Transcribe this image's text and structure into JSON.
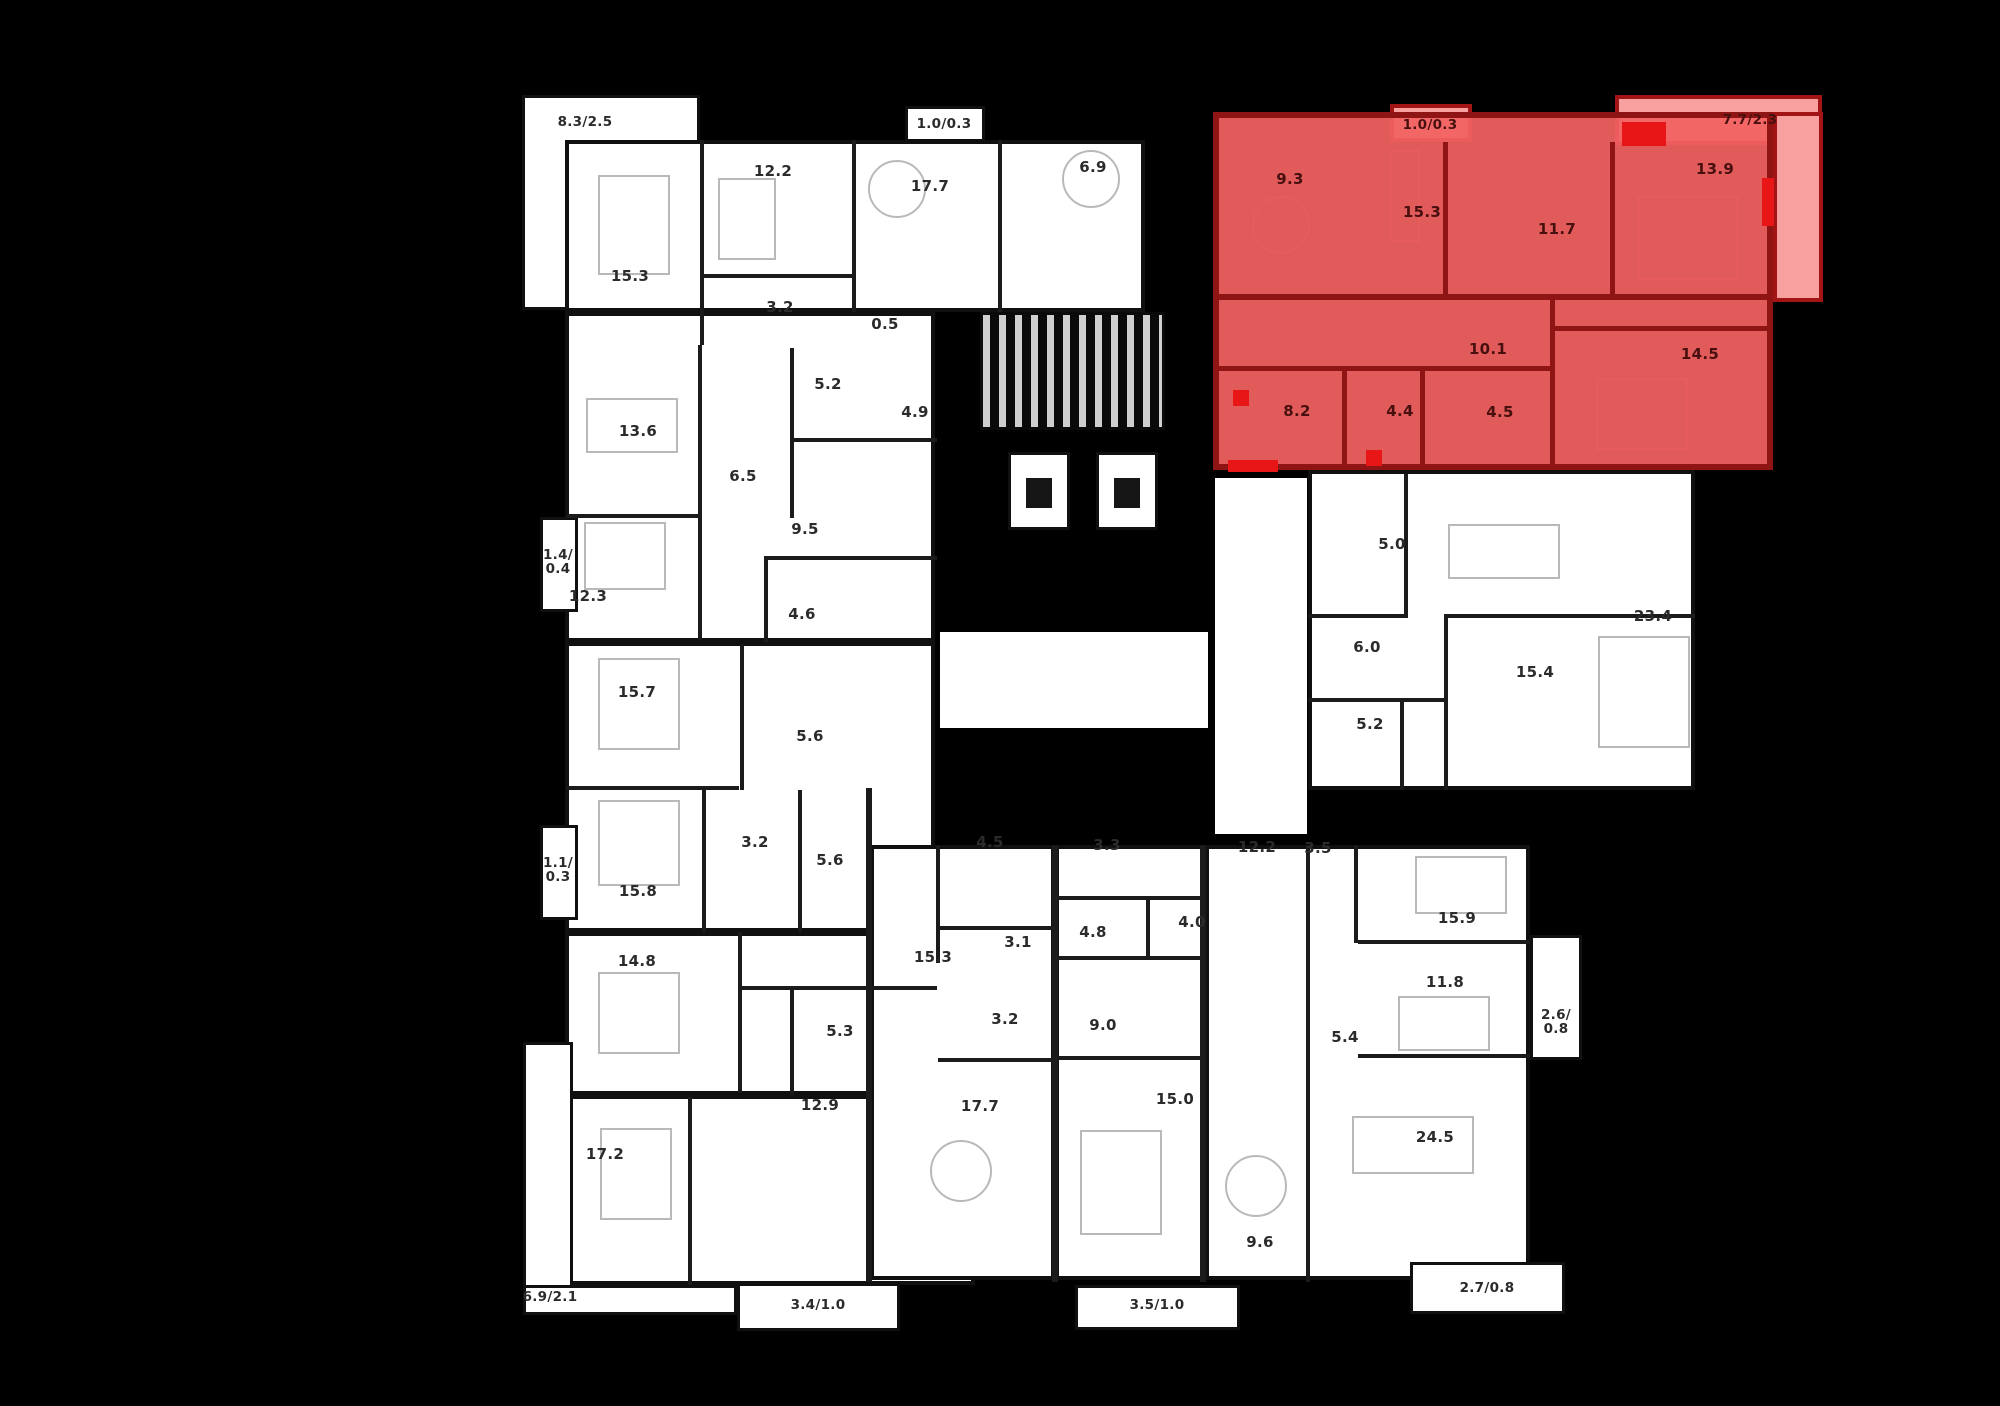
{
  "meta": {
    "view_title": "Residential building floor plan",
    "description": "Black-background architectural floor plate with one apartment highlighted in red (top right). Numbers are room areas in square meters; slash values are balcony/terrace areas."
  },
  "colors": {
    "background": "#000000",
    "floor_fill": "#ffffff",
    "wall": "#1b1b1b",
    "highlight_fill": "#f26262",
    "highlight_wall": "#8f1414",
    "highlight_balcony_fill": "#f8a0a0",
    "accent_red": "#e81616",
    "label_text": "#2b2b2b"
  },
  "highlighted_apartment": {
    "rooms": [
      {
        "area": "9.3",
        "x": 1290,
        "y": 180
      },
      {
        "area": "15.3",
        "x": 1422,
        "y": 213
      },
      {
        "area": "11.7",
        "x": 1557,
        "y": 230
      },
      {
        "area": "13.9",
        "x": 1715,
        "y": 170
      },
      {
        "area": "10.1",
        "x": 1488,
        "y": 350
      },
      {
        "area": "14.5",
        "x": 1700,
        "y": 355
      },
      {
        "area": "8.2",
        "x": 1297,
        "y": 412
      },
      {
        "area": "4.4",
        "x": 1400,
        "y": 412
      },
      {
        "area": "4.5",
        "x": 1500,
        "y": 413
      }
    ],
    "balconies": [
      {
        "area": "1.0/0.3",
        "x": 1430,
        "y": 125
      },
      {
        "area": "7.7/2.3",
        "x": 1750,
        "y": 120
      }
    ]
  },
  "rooms": [
    {
      "area": "15.3",
      "x": 630,
      "y": 277
    },
    {
      "area": "12.2",
      "x": 773,
      "y": 172
    },
    {
      "area": "3.2",
      "x": 780,
      "y": 308
    },
    {
      "area": "0.5",
      "x": 885,
      "y": 325
    },
    {
      "area": "17.7",
      "x": 930,
      "y": 187
    },
    {
      "area": "6.9",
      "x": 1093,
      "y": 168
    },
    {
      "area": "13.6",
      "x": 638,
      "y": 432
    },
    {
      "area": "5.2",
      "x": 828,
      "y": 385
    },
    {
      "area": "4.9",
      "x": 915,
      "y": 413
    },
    {
      "area": "6.5",
      "x": 743,
      "y": 477
    },
    {
      "area": "9.5",
      "x": 805,
      "y": 530
    },
    {
      "area": "12.3",
      "x": 588,
      "y": 597
    },
    {
      "area": "4.6",
      "x": 802,
      "y": 615
    },
    {
      "area": "15.7",
      "x": 637,
      "y": 693
    },
    {
      "area": "5.6",
      "x": 810,
      "y": 737
    },
    {
      "area": "3.2",
      "x": 755,
      "y": 843
    },
    {
      "area": "5.6",
      "x": 830,
      "y": 861
    },
    {
      "area": "15.8",
      "x": 638,
      "y": 892
    },
    {
      "area": "14.8",
      "x": 637,
      "y": 962
    },
    {
      "area": "5.3",
      "x": 840,
      "y": 1032
    },
    {
      "area": "17.2",
      "x": 605,
      "y": 1155
    },
    {
      "area": "12.9",
      "x": 820,
      "y": 1106
    },
    {
      "area": "4.5",
      "x": 990,
      "y": 843
    },
    {
      "area": "15.3",
      "x": 933,
      "y": 958
    },
    {
      "area": "3.1",
      "x": 1018,
      "y": 943
    },
    {
      "area": "3.2",
      "x": 1005,
      "y": 1020
    },
    {
      "area": "17.7",
      "x": 980,
      "y": 1107
    },
    {
      "area": "3.3",
      "x": 1107,
      "y": 846
    },
    {
      "area": "4.8",
      "x": 1093,
      "y": 933
    },
    {
      "area": "4.0",
      "x": 1192,
      "y": 923
    },
    {
      "area": "9.0",
      "x": 1103,
      "y": 1026
    },
    {
      "area": "15.0",
      "x": 1175,
      "y": 1100
    },
    {
      "area": "12.2",
      "x": 1257,
      "y": 848
    },
    {
      "area": "3.5",
      "x": 1318,
      "y": 849
    },
    {
      "area": "15.9",
      "x": 1457,
      "y": 919
    },
    {
      "area": "11.8",
      "x": 1445,
      "y": 983
    },
    {
      "area": "5.4",
      "x": 1345,
      "y": 1038
    },
    {
      "area": "24.5",
      "x": 1435,
      "y": 1138
    },
    {
      "area": "9.6",
      "x": 1260,
      "y": 1243
    },
    {
      "area": "5.0",
      "x": 1392,
      "y": 545
    },
    {
      "area": "23.4",
      "x": 1653,
      "y": 617
    },
    {
      "area": "6.0",
      "x": 1367,
      "y": 648
    },
    {
      "area": "15.4",
      "x": 1535,
      "y": 673
    },
    {
      "area": "5.2",
      "x": 1370,
      "y": 725
    }
  ],
  "balconies": [
    {
      "area": "8.3/2.5",
      "x": 585,
      "y": 122
    },
    {
      "area": "1.0/0.3",
      "x": 944,
      "y": 124
    },
    {
      "area": "1.4/0.4",
      "x": 558,
      "y": 562,
      "wrap": true
    },
    {
      "area": "1.1/0.3",
      "x": 558,
      "y": 870,
      "wrap": true
    },
    {
      "area": "6.9/2.1",
      "x": 550,
      "y": 1297
    },
    {
      "area": "3.4/1.0",
      "x": 818,
      "y": 1305
    },
    {
      "area": "3.5/1.0",
      "x": 1157,
      "y": 1305
    },
    {
      "area": "2.7/0.8",
      "x": 1487,
      "y": 1288
    },
    {
      "area": "2.6/0.8",
      "x": 1556,
      "y": 1022,
      "wrap": true
    }
  ]
}
